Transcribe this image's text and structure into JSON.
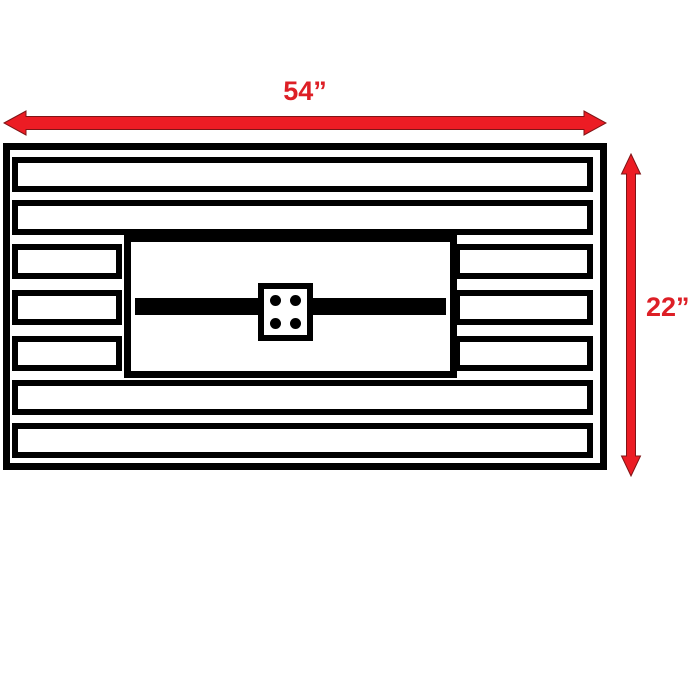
{
  "diagram": {
    "kind": "dimension-drawing",
    "width_dimension": {
      "label": "54”"
    },
    "height_dimension": {
      "label": "22”"
    },
    "colors": {
      "arrow_red": "#EC1C24",
      "arrow_outline": "#7F1416",
      "label_red": "#DD1F26",
      "line_black": "#000000",
      "background": "#FFFFFF"
    },
    "table_top": {
      "slats": [
        {
          "type": "full"
        },
        {
          "type": "full"
        },
        {
          "type": "split"
        },
        {
          "type": "split"
        },
        {
          "type": "split"
        },
        {
          "type": "full"
        },
        {
          "type": "full"
        }
      ],
      "burner": {
        "dots": 4
      }
    }
  }
}
